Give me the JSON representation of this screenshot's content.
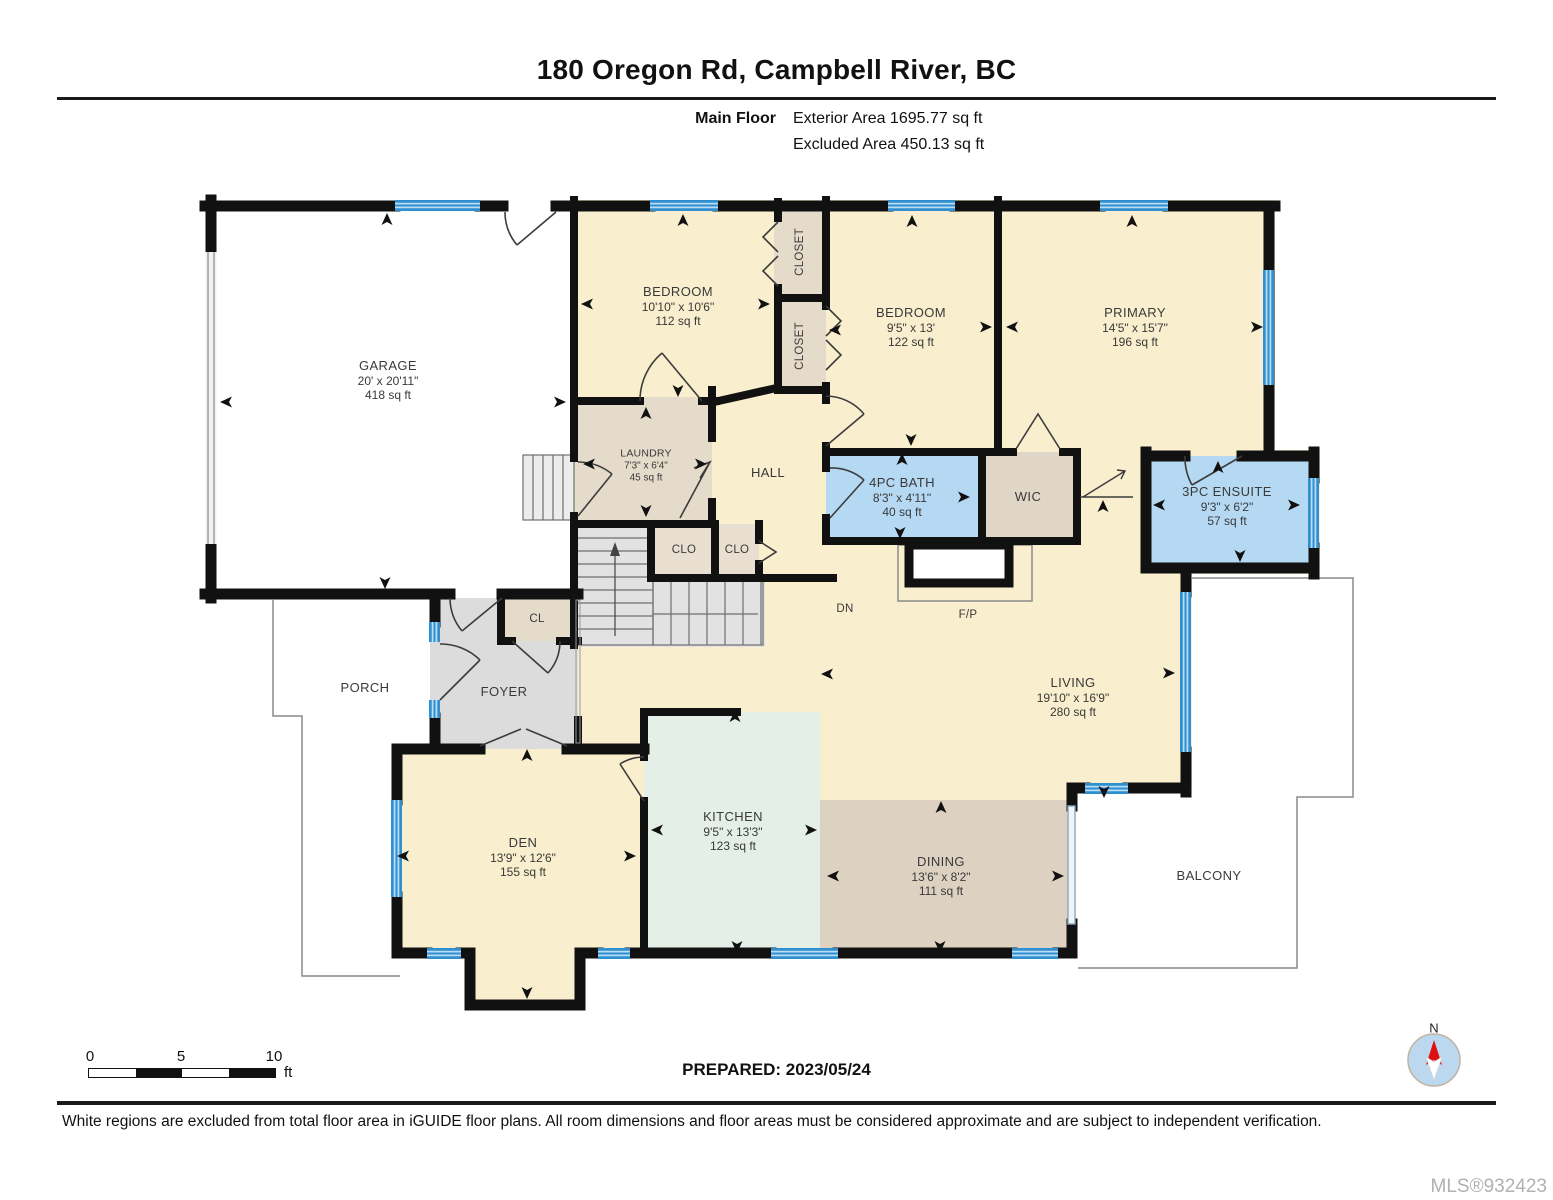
{
  "header": {
    "title": "180 Oregon Rd, Campbell River, BC",
    "floor_label": "Main Floor",
    "exterior_area": "Exterior Area 1695.77 sq ft",
    "excluded_area": "Excluded Area 450.13 sq ft"
  },
  "rooms": {
    "garage": {
      "name": "GARAGE",
      "dims": "20' x 20'11\"",
      "area": "418 sq ft"
    },
    "bedroom1": {
      "name": "BEDROOM",
      "dims": "10'10\" x 10'6\"",
      "area": "112 sq ft"
    },
    "bedroom2": {
      "name": "BEDROOM",
      "dims": "9'5\" x 13'",
      "area": "122 sq ft"
    },
    "primary": {
      "name": "PRIMARY",
      "dims": "14'5\" x 15'7\"",
      "area": "196 sq ft"
    },
    "laundry": {
      "name": "LAUNDRY",
      "dims": "7'3\" x 6'4\"",
      "area": "45 sq ft"
    },
    "bath": {
      "name": "4PC BATH",
      "dims": "8'3\" x 4'11\"",
      "area": "40 sq ft"
    },
    "ensuite": {
      "name": "3PC ENSUITE",
      "dims": "9'3\" x 6'2\"",
      "area": "57 sq ft"
    },
    "living": {
      "name": "LIVING",
      "dims": "19'10\" x 16'9\"",
      "area": "280 sq ft"
    },
    "kitchen": {
      "name": "KITCHEN",
      "dims": "9'5\" x 13'3\"",
      "area": "123 sq ft"
    },
    "dining": {
      "name": "DINING",
      "dims": "13'6\" x 8'2\"",
      "area": "111 sq ft"
    },
    "den": {
      "name": "DEN",
      "dims": "13'9\" x 12'6\"",
      "area": "155 sq ft"
    },
    "hall": {
      "name": "HALL"
    },
    "wic": {
      "name": "WIC"
    },
    "foyer": {
      "name": "FOYER"
    },
    "porch": {
      "name": "PORCH"
    },
    "balcony": {
      "name": "BALCONY"
    },
    "closet_top": {
      "name": "CLOSET"
    },
    "closet_bottom": {
      "name": "CLOSET"
    },
    "clo1": {
      "name": "CLO"
    },
    "clo2": {
      "name": "CLO"
    },
    "cl": {
      "name": "CL"
    },
    "fp": {
      "name": "F/P"
    },
    "dn": {
      "name": "DN"
    }
  },
  "scale_bar": {
    "tick0": "0",
    "tick5": "5",
    "tick10": "10",
    "unit": "ft"
  },
  "compass": {
    "label": "N"
  },
  "footer": {
    "prepared": "PREPARED: 2023/05/24",
    "disclaimer": "White regions are excluded from total floor area in iGUIDE floor plans. All room dimensions and floor areas must be considered approximate and are subject to independent verification.",
    "mls": "MLS®932423"
  },
  "colors": {
    "room_cream": "#f9eecd",
    "room_tan": "#e5dbcb",
    "room_tan_dark": "#ddd2c2",
    "room_blue": "#b5d9f2",
    "room_green": "#e4efe7",
    "room_gray": "#dcdcdc",
    "window_blue": "#2f8fd0",
    "wall_black": "#111111",
    "compass_blue": "#bcd8ee",
    "compass_red": "#dd1111"
  }
}
